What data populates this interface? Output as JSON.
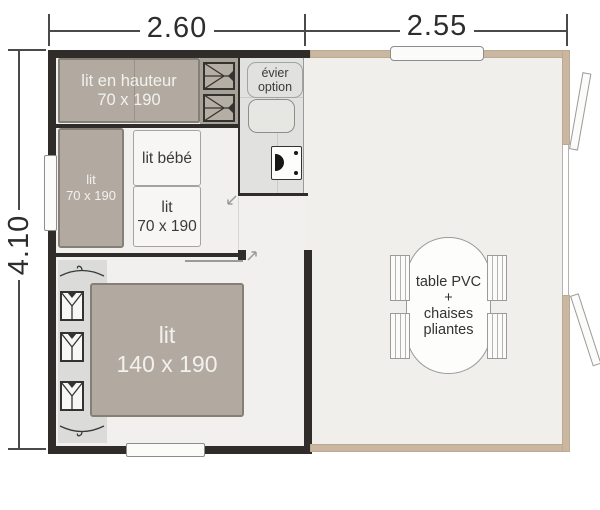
{
  "annotations": {
    "width_left": "2.60",
    "width_right": "2.55",
    "height": "4.10"
  },
  "beds": {
    "bunk": [
      "lit en hauteur",
      "70 x 190"
    ],
    "side": [
      "lit",
      "70 x 190"
    ],
    "baby": [
      "lit bébé"
    ],
    "floor": [
      "lit",
      "70 x 190"
    ],
    "master": [
      "lit",
      "140 x 190"
    ]
  },
  "kitchen": {
    "sink_option": [
      "évier",
      "option"
    ]
  },
  "terrace": {
    "table": [
      "table PVC",
      "+",
      "chaises",
      "pliantes"
    ]
  },
  "colors": {
    "wall_dark": "#2f2c29",
    "wall_tan": "#c9b7a2",
    "floor": "#f1f0ee",
    "counter": "#e1e1df",
    "bed_fill": "#b2aaa0",
    "bed_border": "#858076",
    "closet_fill": "#dbdbd9",
    "bed_text": "#f2f1ee",
    "label_text": "#3a3a3a",
    "dim_text": "#2d2d2d"
  }
}
